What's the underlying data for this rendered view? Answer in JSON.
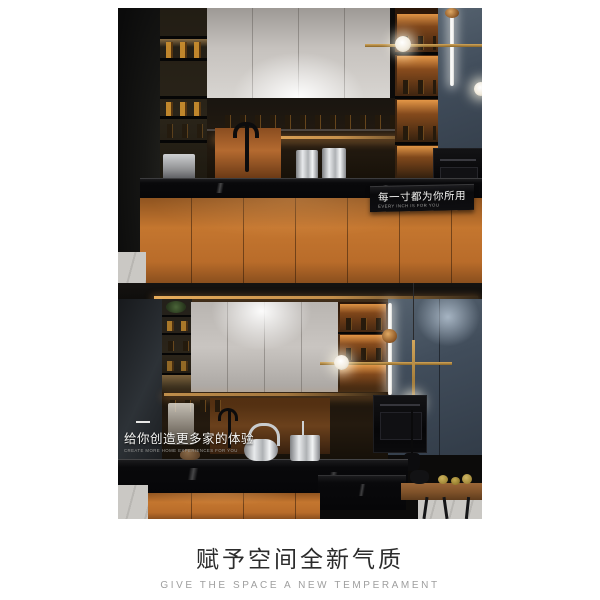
{
  "hero_top": {
    "caption": {
      "cn": "每一寸都为你所用",
      "en": "EVERY INCH IS FOR YOU"
    }
  },
  "hero_bottom": {
    "caption": {
      "cn": "给你创造更多家的体验",
      "en": "CREATE MORE HOME EXPERIENCES FOR YOU"
    }
  },
  "footer": {
    "title": "赋予空间全新气质",
    "subtitle": "GIVE THE SPACE A NEW TEMPERAMENT"
  },
  "palette": {
    "background": "#ffffff",
    "cabinet_orange": "#c4762f",
    "cabinet_blue_gray": "#46536a",
    "copper_glow": "#c57a36",
    "marble_black": "#0a0a0c",
    "white_cabinet": "#d6d3cf",
    "gold_accent": "#c99a4b",
    "led_warm": "#ffb95e",
    "title_color": "#2c2c2c",
    "subtitle_color": "#9e9e9e",
    "caption_text": "#f4f4f2"
  }
}
